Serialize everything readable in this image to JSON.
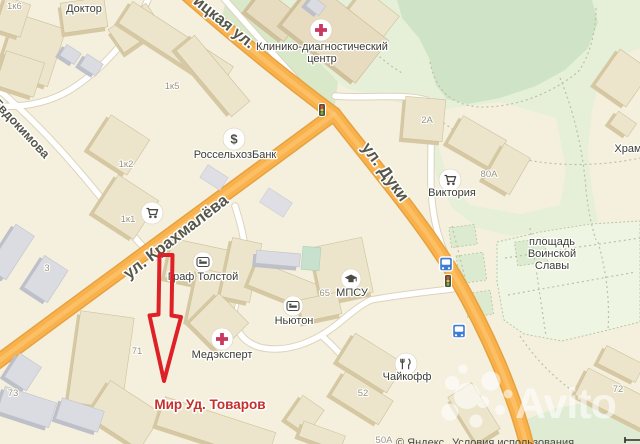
{
  "app": {
    "watermark": "Avito",
    "provider_attribution": {
      "copyright": "© Яндекс",
      "terms_link": "Условия использования"
    }
  },
  "map": {
    "marker": {
      "label": "Мир Уд. Товаров"
    },
    "streets": [
      {
        "id": "bezhitskaya",
        "name": "ицкая ул."
      },
      {
        "id": "duki",
        "name": "ул. Дуки"
      },
      {
        "id": "krakhmaleva",
        "name": "ул. Крахмалёва"
      },
      {
        "id": "evdokimova",
        "name": "Евдокимова"
      }
    ],
    "pois": [
      {
        "id": "doktor",
        "lines": [
          "Доктор"
        ],
        "icon": ""
      },
      {
        "id": "clinic",
        "lines": [
          "Клинико-диагностический",
          "центр"
        ],
        "icon": "medical-cross-icon"
      },
      {
        "id": "bank",
        "lines": [
          "РоссельхозБанк"
        ],
        "icon": "dollar-icon"
      },
      {
        "id": "victoria",
        "lines": [
          "Виктория"
        ],
        "icon": "cart-icon"
      },
      {
        "id": "store-1k1",
        "lines": [],
        "icon": "cart-icon"
      },
      {
        "id": "khram",
        "lines": [
          "Храм"
        ],
        "icon": ""
      },
      {
        "id": "graf-tolstoy",
        "lines": [
          "Граф Толстой"
        ],
        "icon": "bed-icon"
      },
      {
        "id": "newton",
        "lines": [
          "Ньютон"
        ],
        "icon": "bed-icon"
      },
      {
        "id": "medexpert",
        "lines": [
          "Медэксперт"
        ],
        "icon": "medical-cross-icon"
      },
      {
        "id": "mpsu",
        "lines": [
          "МПСУ"
        ],
        "icon": "graduation-cap-icon"
      },
      {
        "id": "chaykoff",
        "lines": [
          "Чайкофф"
        ],
        "icon": "restaurant-icon"
      },
      {
        "id": "ploshchad-voinskoy-slavy",
        "lines": [
          "площадь",
          "Воинской",
          "Славы"
        ],
        "icon": ""
      }
    ],
    "building_numbers": [
      {
        "text": "1к6"
      },
      {
        "text": "1к5"
      },
      {
        "text": "1к2"
      },
      {
        "text": "1к1"
      },
      {
        "text": "2А"
      },
      {
        "text": "80А"
      },
      {
        "text": "3"
      },
      {
        "text": "71"
      },
      {
        "text": "73"
      },
      {
        "text": "52"
      },
      {
        "text": "72"
      },
      {
        "text": "50А"
      },
      {
        "text": "65"
      }
    ],
    "transport_icons": [
      "bus-stop-icon",
      "bus-stop-icon",
      "traffic-light-icon",
      "traffic-light-icon"
    ],
    "colors": {
      "background": "#f5f0de",
      "road_orange": "#f9b14c",
      "road_casing": "#e7a13e",
      "park_green": "#cfe4c6",
      "park_light": "#e6f0d8",
      "plaza": "#eff5e3",
      "building": "#ede5cb",
      "building_side": "#d5c8a3",
      "marker_red": "#de2126",
      "marker_label_red": "#c5312a",
      "bus_blue": "#3e7ed2"
    }
  }
}
